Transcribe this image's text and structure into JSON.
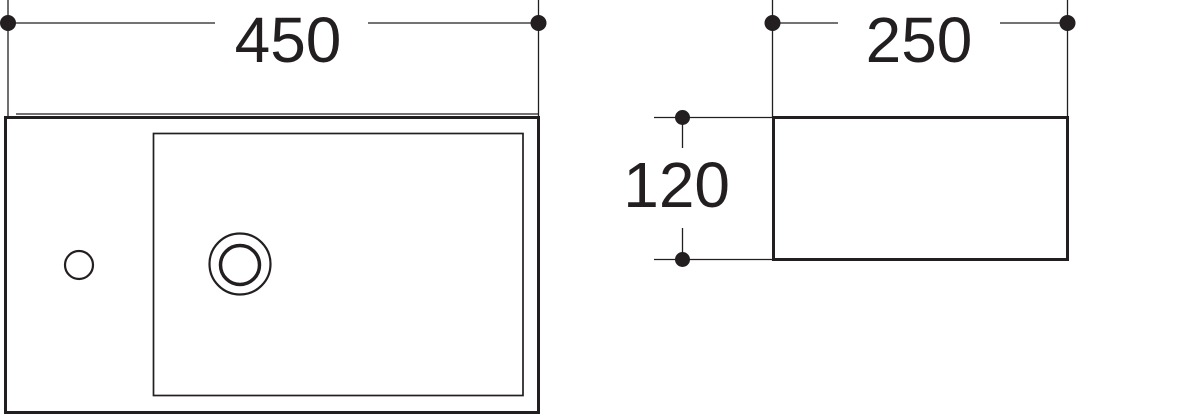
{
  "drawing": {
    "colors": {
      "line": "#231f20",
      "background": "#ffffff"
    },
    "top_view": {
      "width_label": "450"
    },
    "side_view": {
      "width_label": "250",
      "height_label": "120"
    }
  }
}
